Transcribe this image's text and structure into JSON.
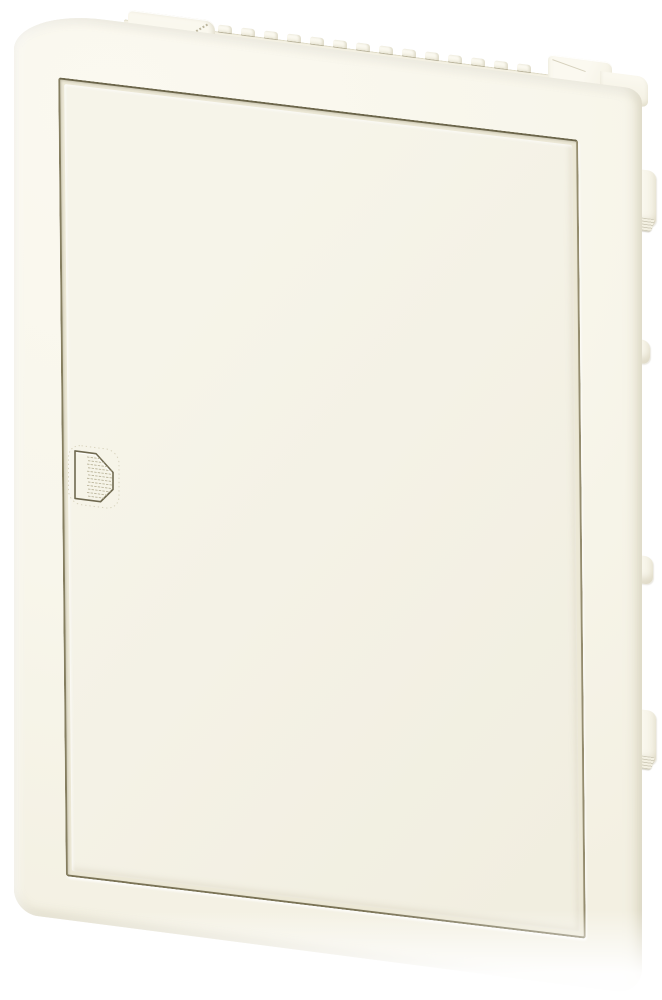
{
  "meta": {
    "domain": "Natural-Image",
    "alt": "Ivory flush-mounted small distribution board with closed blank door, recessed grip handle on the left side and mounting clips on the right edge",
    "visible_text": []
  },
  "product": {
    "kind": "flush-mounted distribution board (consumer unit) with door",
    "finish": "cream / ivory plastic",
    "view": "front view, slight perspective with right side receding downward",
    "door_state": "closed"
  },
  "colors": {
    "background": "#ffffff",
    "body_light": "#fbf9f0",
    "body": "#f8f6eb",
    "body_mid": "#f3f0e2",
    "door_face": "#f6f4e9",
    "door_face_deep": "#f1eee0",
    "recess_return": "#ece8d6",
    "edge_shadow": "#ddd8c2",
    "seam_top": "#6b654a",
    "seam_right": "#948c6e",
    "seam_bottom": "#7a7355",
    "seam_left": "#857e60",
    "seam_soft": "#a39b7d",
    "grip_line": "#bcb69c",
    "dotted_outline": "#d8d3bd",
    "handle_outline": "#6f6950",
    "handle_fill": "#f6f4e8"
  },
  "parts": {
    "rear_box": {
      "vent_teeth": {
        "count": 14,
        "start_x": 204,
        "pitch": 23,
        "width": 14,
        "height": 7,
        "top": -10
      },
      "wall_clips": [
        {
          "top": 80,
          "height": 56,
          "width": 34,
          "foot": true
        },
        {
          "top": 250,
          "height": 24,
          "width": 28,
          "foot": false
        },
        {
          "top": 466,
          "height": 28,
          "width": 31,
          "foot": false
        },
        {
          "top": 620,
          "height": 54,
          "width": 34,
          "foot": true
        }
      ],
      "mounting_tab_count": 2
    },
    "handle": {
      "grip_line_count": 12
    }
  }
}
